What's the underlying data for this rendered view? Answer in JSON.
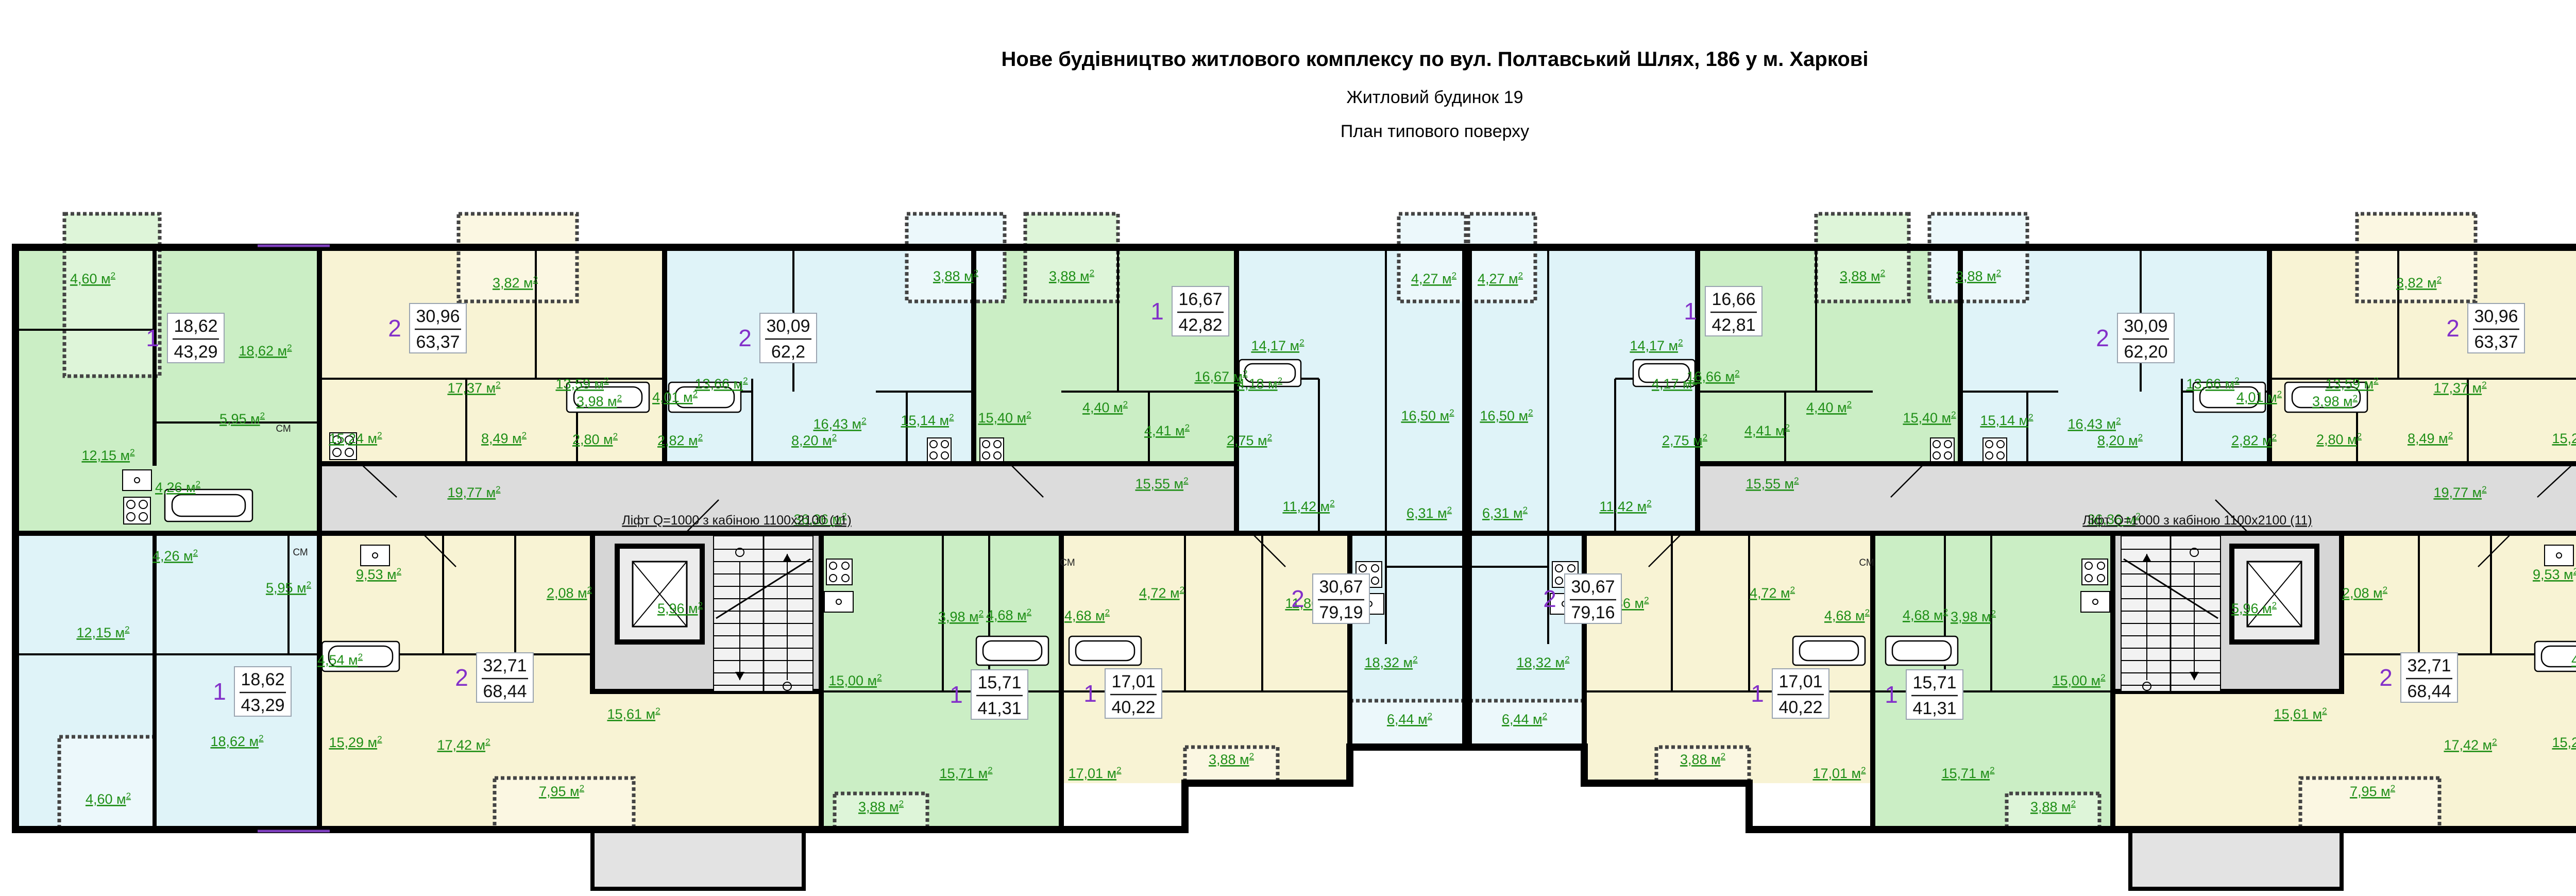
{
  "title": {
    "line1": "Нове будівництво житлового комплексу по вул. Полтавський Шлях, 186 у м. Харкові",
    "line2": "Житловий будинок 19",
    "line3": "План типового поверху"
  },
  "colors": {
    "green_room": "#cbeec5",
    "green_loggia": "#def5d9",
    "yellow_room": "#f8f3d4",
    "yellow_loggia": "#fbf7e2",
    "blue_room": "#dff3f8",
    "blue_loggia": "#ecf8fb",
    "corridor_grey": "#dcdcdc",
    "core_grey": "#d6d6d6",
    "label_green": "#1f8f17",
    "apartment_number_purple": "#8330c9",
    "wall_black": "#000000",
    "accent_violet": "#7f3fbf"
  },
  "lift_label": "Ліфт Q=1000 з кабіною 1100х2100  (11)",
  "cm_label": "СМ",
  "area_unit": "м",
  "labels": {
    "cor_19": "19,77",
    "cor_36": "36,36",
    "cor_15": "15,55",
    "core_lift": "5,96",
    "a_log": "4,60",
    "a_liv": "18,62",
    "a_hall": "5,95",
    "a_kit": "12,15",
    "a_bath": "4,26",
    "b_log": "3,82",
    "b_r1": "17,37",
    "b_r2": "13,59",
    "b_kit": "15,24",
    "b_hall": "8,49",
    "b_bath": "3,98",
    "b_wc": "2,80",
    "c_log": "3,88",
    "c_r1": "13,66",
    "c_r2": "16,43",
    "c_bath": "4,01",
    "c_wc": "2,82",
    "c_hall": "8,20",
    "c_kit": "15,14",
    "d_log": "3,88",
    "d_kit": "15,40",
    "d_liv": "16,67",
    "d_hall": "4,40",
    "d_bath": "4,41",
    "e_log": "4,27",
    "e_r1": "14,17",
    "e_r2": "16,50",
    "e_bath": "4,18",
    "e_wc": "2,75",
    "e_hall": "11,42",
    "e_r3": "6,31",
    "e_liv": "18,32",
    "e_balc": "6,44",
    "f_liv": "18,62",
    "f_kit": "12,15",
    "f_hall": "5,95",
    "f_bath": "4,26",
    "f_log": "4,60",
    "g_kit": "9,53",
    "g_wc": "2,08",
    "g_bath": "4,54",
    "g_hall": "15,61",
    "g_r1": "15,29",
    "g_r2": "17,42",
    "g_log": "7,95",
    "h_kit": "15,00",
    "h_wc": "3,98",
    "h_bath": "4,68",
    "h_liv": "15,71",
    "h_log": "3,88",
    "i_hall": "4,72",
    "i_bath": "4,68",
    "i_kit": "11,86",
    "i_liv": "17,01",
    "i_log": "3,88"
  },
  "mirror_overrides": {
    "d_liv": "16,66",
    "e_bath": "4,17"
  },
  "apartment_boxes": [
    {
      "id": "a",
      "num": "1",
      "living": "18,62",
      "total": "43,29"
    },
    {
      "id": "b",
      "num": "2",
      "living": "30,96",
      "total": "63,37"
    },
    {
      "id": "c",
      "num": "2",
      "living": "30,09",
      "total": "62,2",
      "m_total": "62,20"
    },
    {
      "id": "d",
      "num": "1",
      "living": "16,67",
      "total": "42,82",
      "m_living": "16,66",
      "m_total": "42,81"
    },
    {
      "id": "e",
      "num": "2",
      "living": "30,67",
      "total": "79,19",
      "m_total": "79,16"
    },
    {
      "id": "f",
      "num": "1",
      "living": "18,62",
      "total": "43,29"
    },
    {
      "id": "g",
      "num": "2",
      "living": "32,71",
      "total": "68,44"
    },
    {
      "id": "h",
      "num": "1",
      "living": "15,71",
      "total": "41,31"
    },
    {
      "id": "i",
      "num": "1",
      "living": "17,01",
      "total": "40,22"
    }
  ]
}
